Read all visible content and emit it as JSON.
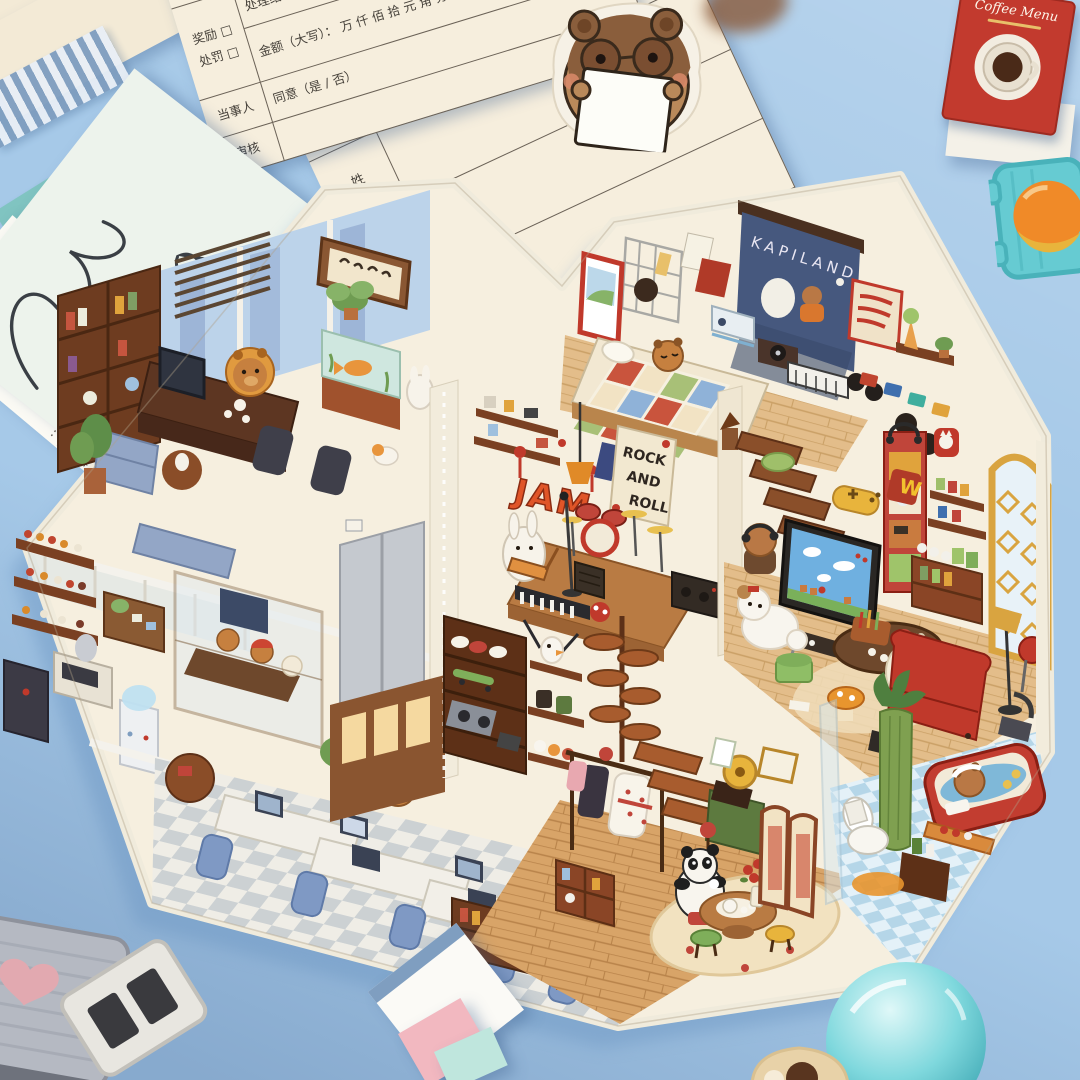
{
  "scene": {
    "description": "photo of a capybara dollhouse paper diorama lying on a blue desk with leave-request forms, stickers and miniatures",
    "colors": {
      "desk_blue": "#a6c9e8",
      "shadow_blue": "#7fa6cf",
      "paper_cream": "#f6eedd",
      "diorama_cream": "#f6efdf",
      "wood_dark": "#5d3017",
      "wood_mid": "#a85c2e",
      "wood_floor": "#e3bd8a",
      "accent_red": "#c0392b",
      "chair_blue": "#7f99c4",
      "screen_navy": "#46587e",
      "teal": "#66cbd2",
      "gold": "#d9a440"
    }
  },
  "forms": {
    "reward_form": {
      "date_label": "日期:",
      "year_label": "年",
      "name": "姓名",
      "reason": "事由:",
      "reward": "奖励 □",
      "punish": "处罚 □",
      "result": "处理结果:",
      "amount": "金额（大写）：",
      "amount_units": "万  仟  佰  拾  元  角  分   ¥",
      "party": "当事人",
      "agree": "同意（是 / 否）",
      "review": "审核",
      "issuer": "开单人",
      "approver": "审批人"
    },
    "leave_form": {
      "col1": "姓",
      "col2": "请假事",
      "col3": "要求"
    },
    "approval_card": {
      "label": "批准人:"
    }
  },
  "mini_book": {
    "title": "Coffee Menu"
  },
  "diorama": {
    "screen_title": "KAPILAND",
    "poster": {
      "line1": "ROCK",
      "line2": "AND",
      "line3": "ROLL"
    },
    "graffiti": "JAM",
    "neon": "W",
    "rooms": [
      "executive-office",
      "meeting-room",
      "open-plan-office",
      "bedroom-cinema",
      "music-room",
      "gaming-lounge",
      "sneaker-display",
      "tea-room",
      "bathroom",
      "elevator"
    ],
    "characters": [
      "boss-capybara",
      "meeting-capybaras",
      "sleeping-office-capybara",
      "bedroom-sleeping-capybara",
      "rabbit-guitarist",
      "stairs-capybara-headphones",
      "white-dog",
      "white-capybara",
      "panda-tea",
      "bathing-capybara"
    ]
  }
}
